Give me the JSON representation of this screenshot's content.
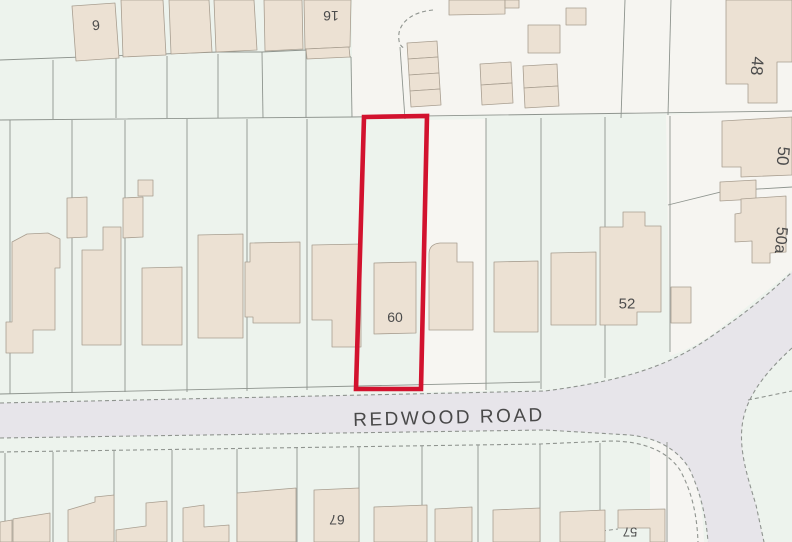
{
  "map": {
    "road": {
      "name": "REDWOOD ROAD",
      "x": 449,
      "y": 418,
      "rot": -1.5
    },
    "highlight_plot": {
      "label": "60",
      "outline_color": "#d2122e"
    },
    "house_numbers": [
      {
        "text": "9",
        "x": 96,
        "y": 25,
        "rot": -6,
        "size": 14
      },
      {
        "text": "16",
        "x": 331,
        "y": 16,
        "rot": 180,
        "size": 14
      },
      {
        "text": "48",
        "x": 757,
        "y": 66,
        "rot": 95,
        "size": 17
      },
      {
        "text": "50",
        "x": 783,
        "y": 156,
        "rot": 95,
        "size": 17
      },
      {
        "text": "50a",
        "x": 780,
        "y": 240,
        "rot": 95,
        "size": 16
      },
      {
        "text": "52",
        "x": 627,
        "y": 304,
        "rot": 0,
        "size": 15
      },
      {
        "text": "60",
        "x": 395,
        "y": 317,
        "rot": 0,
        "size": 14
      },
      {
        "text": "67",
        "x": 337,
        "y": 520,
        "rot": 180,
        "size": 14
      },
      {
        "text": "57",
        "x": 630,
        "y": 532,
        "rot": 180,
        "size": 13
      }
    ],
    "colors": {
      "background": "#edf3ed",
      "pale_area": "#f6f5f1",
      "road_fill": "#e7e5ea",
      "building_fill": "#ece1d3",
      "building_stroke": "#a89e90",
      "boundary_line": "#8e948e",
      "dashed_line": "#8f948f",
      "highlight_red": "#d2122e",
      "label_text": "#4c4c4c"
    }
  }
}
